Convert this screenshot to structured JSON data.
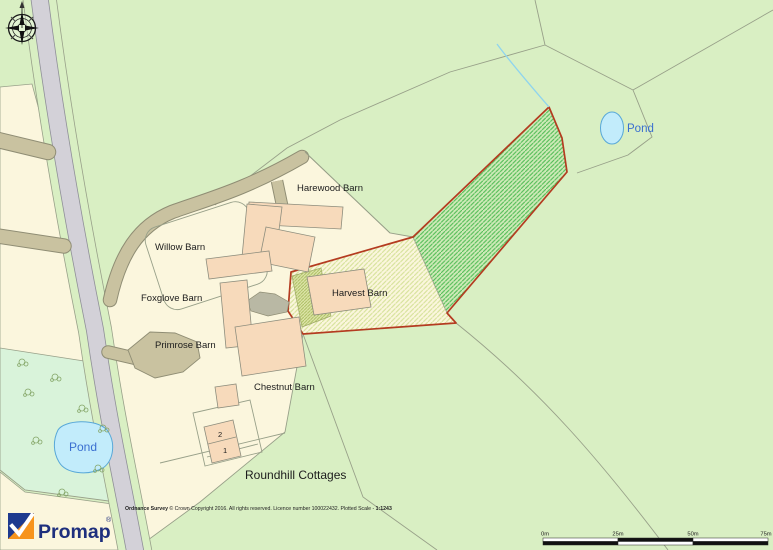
{
  "map": {
    "labels": {
      "harewood": "Harewood Barn",
      "willow": "Willow Barn",
      "foxglove": "Foxglove Barn",
      "primrose": "Primrose Barn",
      "chestnut": "Chestnut Barn",
      "harvest": "Harvest Barn",
      "roundhill": "Roundhill Cottages",
      "pond_ne": "Pond",
      "pond_sw": "Pond",
      "cottage_no_2": "2",
      "cottage_no_1": "1"
    },
    "colors": {
      "field_green": "#d9efc3",
      "teal_field": "#d9f3da",
      "cream": "#fbf6dd",
      "road_gray": "#d3d1d8",
      "track_tan": "#c9c2a0",
      "building_peach": "#f7dabb",
      "yard_gray": "#b9b8a4",
      "boundary_line": "#98a089",
      "red_boundary": "#b43b20",
      "hatch_green": "#53bd57",
      "hatch_pale": "#d6e29b",
      "hatch_olive": "#a9bd60",
      "pond_fill": "#c2ecfb",
      "pond_stroke": "#58a8d8",
      "stream_blue": "#8fd4ee"
    }
  },
  "footer": {
    "copyright_bold": "Ordnance Survey",
    "copyright_rest": " © Crown Copyright 2016. All rights reserved. Licence number 100022432. Plotted Scale - ",
    "plotted_scale": "1:1243"
  },
  "scale_bar": {
    "labels": [
      "0m",
      "25m",
      "50m",
      "75m"
    ]
  },
  "logo": {
    "brand": "Promap",
    "registered": "®"
  }
}
